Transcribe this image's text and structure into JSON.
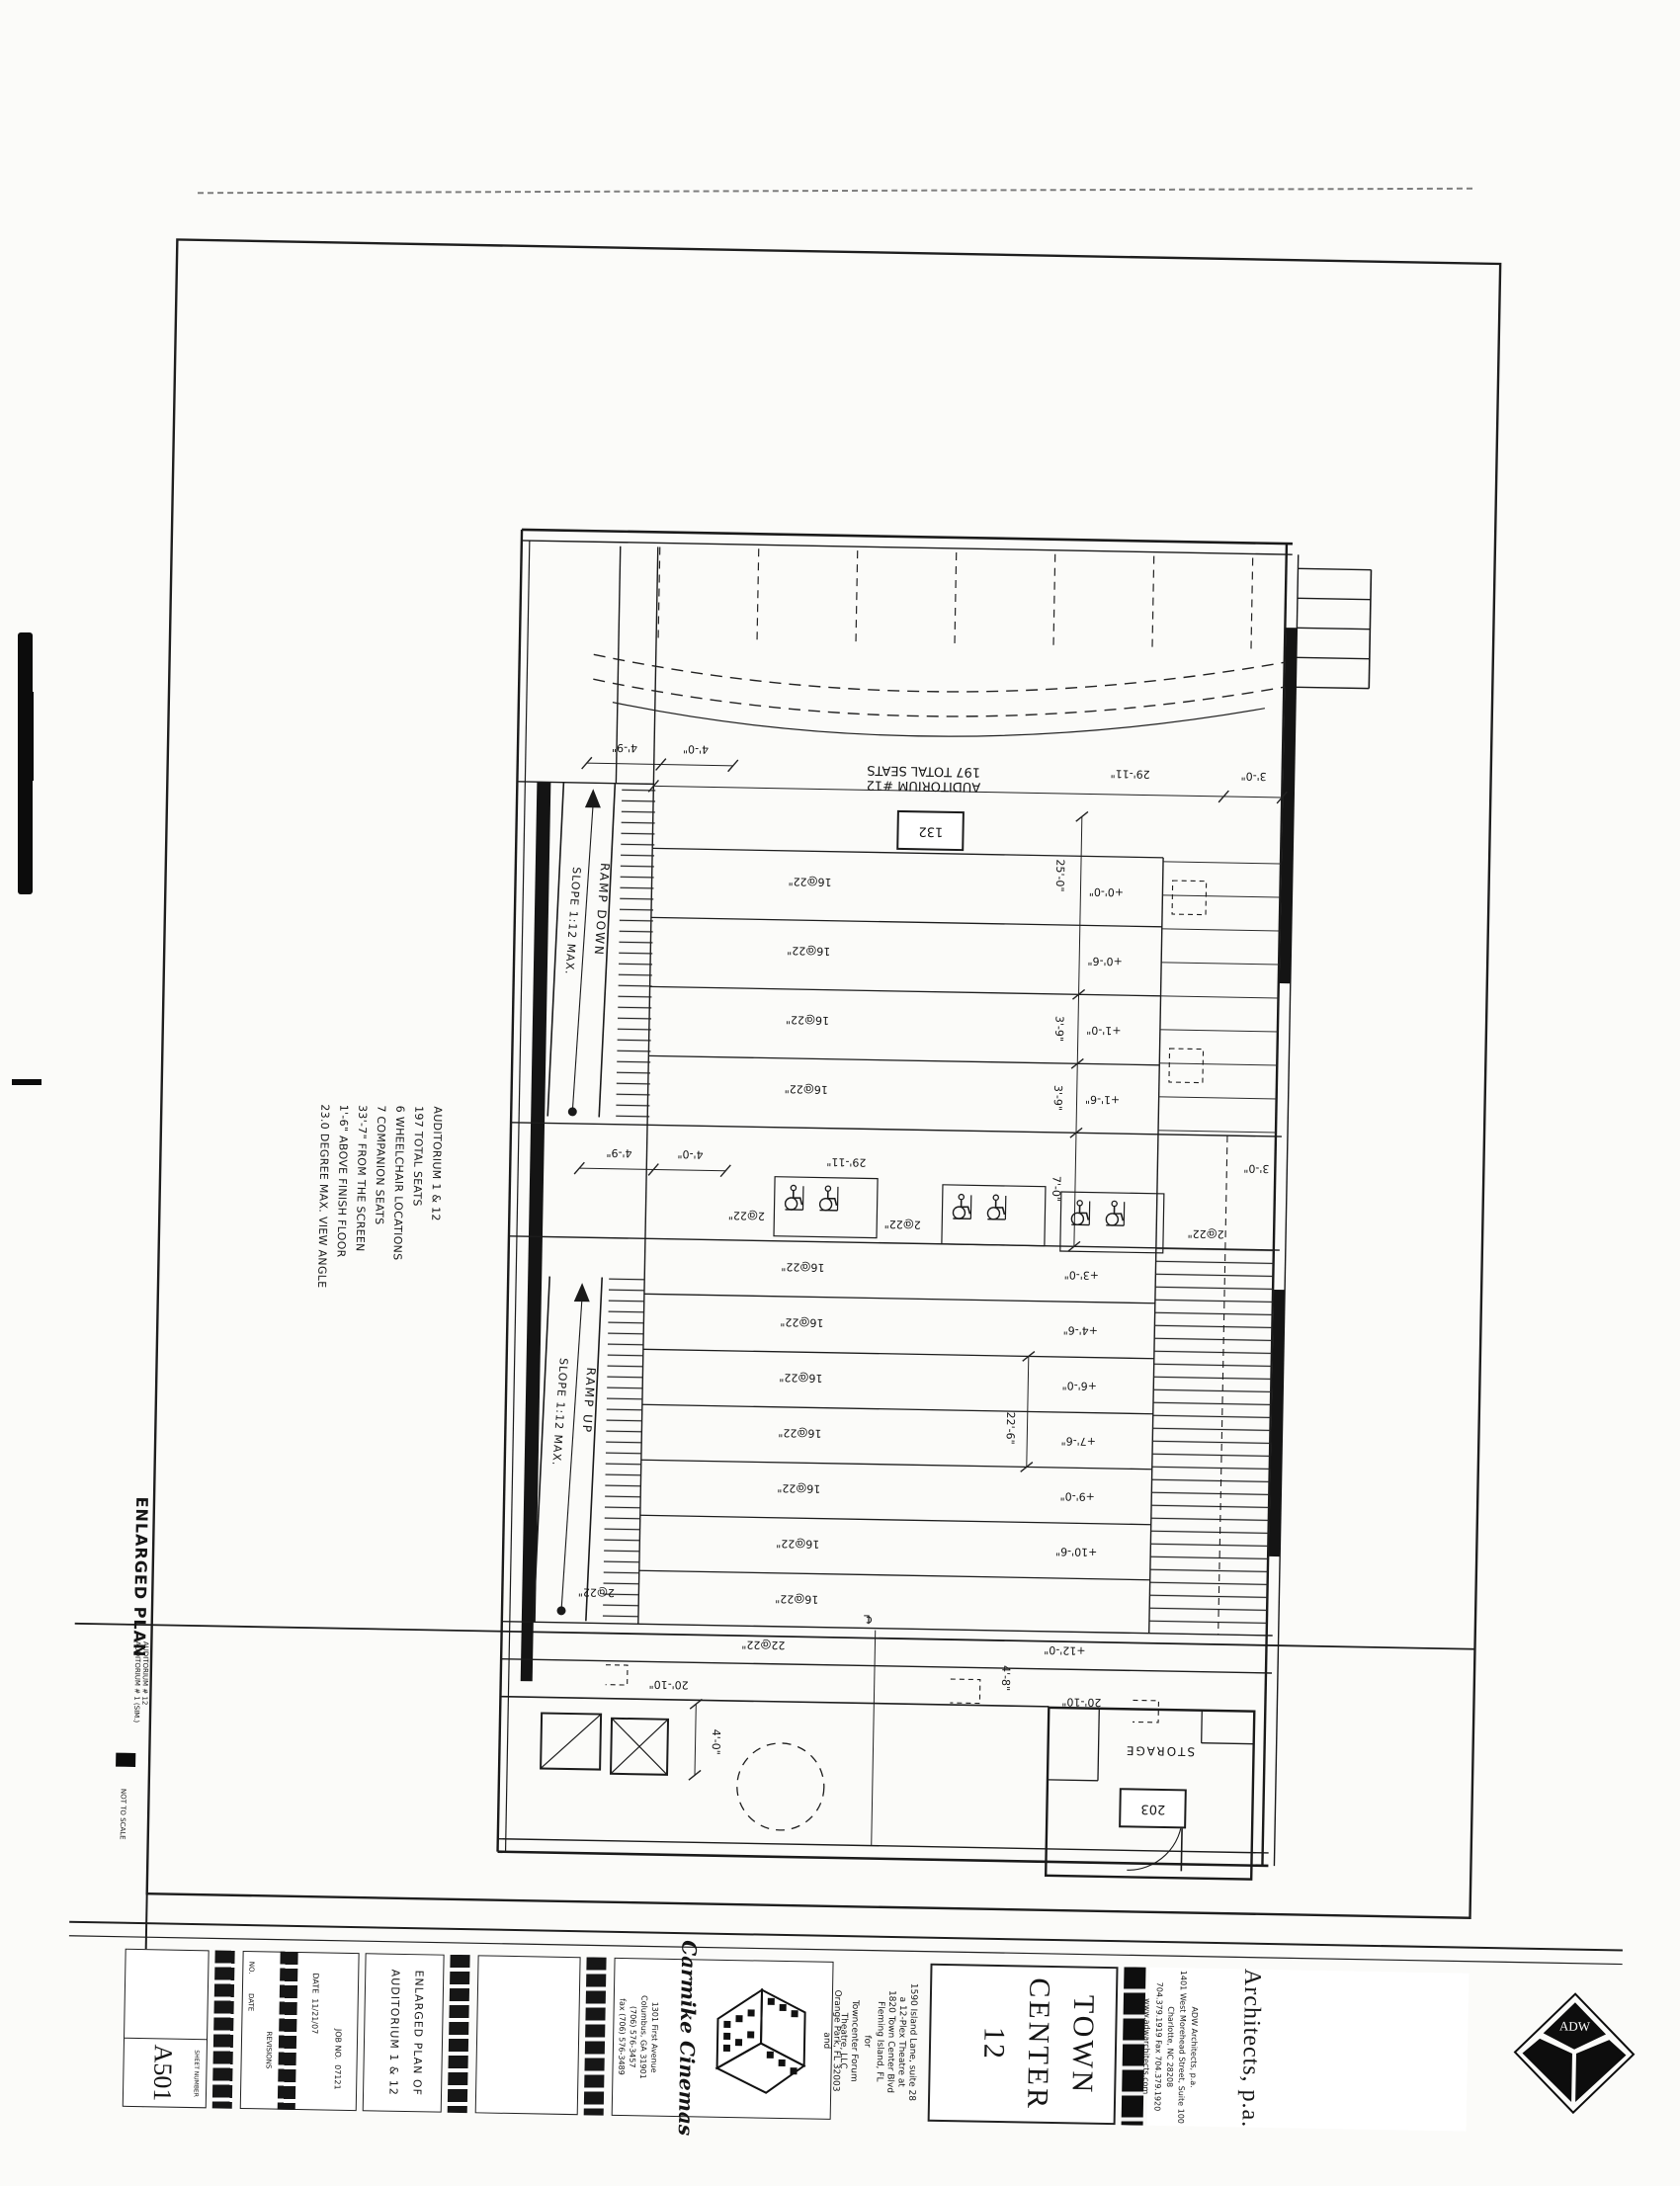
{
  "plan": {
    "auditorium_line1": "AUDITORIUM #12",
    "auditorium_line2": "197 TOTAL SEATS",
    "room_tag": "132",
    "ramp_down_label": "RAMP DOWN",
    "ramp_down_slope": "SLOPE 1:12 MAX.",
    "ramp_up_label": "RAMP UP",
    "ramp_up_slope": "SLOPE 1:12 MAX.",
    "storage_label": "STORAGE",
    "storage_tag": "203",
    "row_label_16": "16@22\"",
    "row_label_2": "2@22\"",
    "row_label_22": "22@22\"",
    "centerline_symbol": "℄",
    "elevations_upper": [
      "+0'-0\"",
      "+0'-6\"",
      "+1'-0\"",
      "+1'-6\""
    ],
    "elevations_lower": [
      "+3'-0\"",
      "+4'-6\"",
      "+6'-0\"",
      "+7'-6\"",
      "+9'-0\"",
      "+10'-6\"",
      "+12'-0\""
    ],
    "dims": {
      "aisle_ramp": "4'-9\"",
      "aisle_stair": "4'-0\"",
      "seating_width": "29'-11\"",
      "right_offset": "3'-0\"",
      "upper_depth": "25'-0\"",
      "row_a": "3'-9\"",
      "row_b": "3'-9\"",
      "cross_aisle": "7'-0\"",
      "lower_depth": "22'-6\"",
      "exit_width": "4'-8\"",
      "corridor_left": "20'-10\"",
      "corridor_right": "20'-10\"",
      "corridor_width": "4'-0\""
    }
  },
  "notes": {
    "lines": [
      "AUDITORIUM 1 & 12",
      "197 TOTAL SEATS",
      "6 WHEELCHAIR LOCATIONS",
      "7 COMPANION SEATS",
      "33'-7\" FROM THE SCREEN",
      "1'-6\" ABOVE FINISH FLOOR",
      "23.0 DEGREE MAX. VIEW ANGLE"
    ]
  },
  "drawing_title": {
    "title": "ENLARGED PLAN",
    "sub1": "AUDITORIUM # 12",
    "sub2": "AUDITORIUM # 1 (SIM.)",
    "scale": "NOT TO SCALE"
  },
  "titleblock": {
    "sheet_label": "SHEET NUMBER",
    "sheet_number": "A501",
    "revisions": {
      "header": "REVISIONS",
      "no": "NO.",
      "date": "DATE",
      "date_label": "DATE",
      "date_value": "11/21/07",
      "job_label": "JOB NO.",
      "job_value": "07121"
    },
    "sheet_title": {
      "line1": "ENLARGED PLAN OF",
      "line2": "AUDITORIUM 1 & 12"
    },
    "carmike": {
      "logo": "Carmike Cinemas",
      "addr1": "1301 First Avenue",
      "addr2": "Columbus, GA 31901",
      "phone": "(706) 576-3457",
      "fax": "fax (706) 576-3489",
      "and": "and"
    },
    "project": {
      "l1": "a 12-Plex Theatre at",
      "l2": "1820 Town Center Blvd",
      "l3": "Fleming Island, FL",
      "for": "for",
      "c1": "Towncenter Forum",
      "c2": "Theatre, LLC",
      "c3": "1590 Island Lane, suite 28",
      "c4": "Orange Park, FL 32003"
    },
    "project_name": {
      "l1": "TOWN",
      "l2": "CENTER",
      "l3": "12"
    },
    "architect": {
      "big": "Architects, p.a.",
      "a1": "ADW Architects, p.a.",
      "a2": "1401 West Morehead Street, Suite 100",
      "a3": "Charlotte, NC 28208",
      "a4": "704.379.1919 Fax 704.379.1920",
      "a5": "www.adwarchitects.com",
      "logo": "ADW"
    }
  }
}
